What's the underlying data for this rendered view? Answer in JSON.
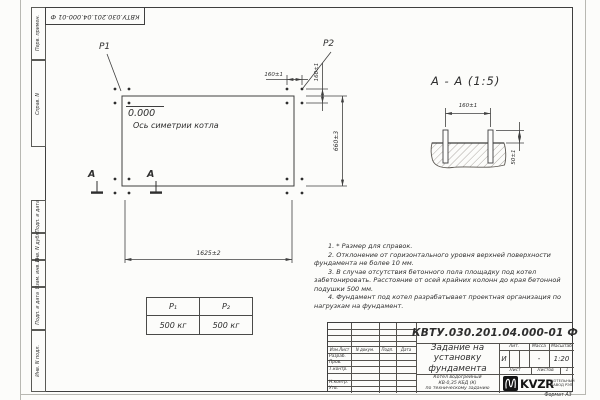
{
  "sheet": {
    "top_stamp": "КВТУ.030.201.04.000-01 Ф",
    "format_label": "Формат А3"
  },
  "colors": {
    "line": "#3f3f3f",
    "paper": "#fcfcfa",
    "logo_black": "#141414"
  },
  "margin_labels": [
    "Перв. примен.",
    "Справ. N",
    "Подп. и дата",
    "Инв. N дубл.",
    "Взам. инв. N",
    "Подп. и дата",
    "Инв. N подл."
  ],
  "plan": {
    "p1_label": "P1",
    "p2_label": "P2",
    "elevation": "0.000",
    "axis_label": "Ось симетрии котла",
    "section_mark": "A",
    "dim_width": "1625±2",
    "dim_height": "660±3",
    "dim_bolt_spacing_x": "160±1",
    "dim_bolt_spacing_y": "160±1"
  },
  "section_view": {
    "title": "А - А (1:5)",
    "dim_bolt_spacing": "160±1",
    "dim_protrusion": "50±1"
  },
  "load_table": {
    "headers": [
      "P₁",
      "P₂"
    ],
    "values": [
      "500 кг",
      "500 кг"
    ]
  },
  "notes": [
    "1. * Размер для справок.",
    "2. Отклонение от горизонтального уровня верхней поверхности фундамента не более 10 мм.",
    "3. В случае отсутствия бетонного пола площадку под котел забетонировать. Расстояние от осей крайних колонн до края бетонной подушки 500 мм.",
    "4. Фундамент под котел разрабатывает проектная организация по нагрузкам на фундамент."
  ],
  "title_block": {
    "doc_number": "КВТУ.030.201.04.000-01 Ф",
    "title": "Задание на установку фундамента",
    "product_lines": [
      "Котел водогрейный",
      "КВ-0,35 КБД (К)",
      "по техническому заданию"
    ],
    "header_cols": [
      "Изм.Лист",
      "N докум.",
      "Подп.",
      "Дата"
    ],
    "sig_rows": [
      "Разраб.",
      "Пров.",
      "Т.контр.",
      "",
      "Н.контр.",
      "Утв."
    ],
    "lit_label": "Лит.",
    "mass_label": "Масса",
    "scale_label": "Масштаб",
    "lit_value": "И",
    "mass_value": "-",
    "scale_value": "1:20",
    "sheet_label": "Лист",
    "sheets_label": "Листов",
    "sheets_value": "1",
    "logo_text": "KVZR",
    "logo_caption": "КОТЕЛЬНЫЙ ЗАВОД РЭП"
  }
}
